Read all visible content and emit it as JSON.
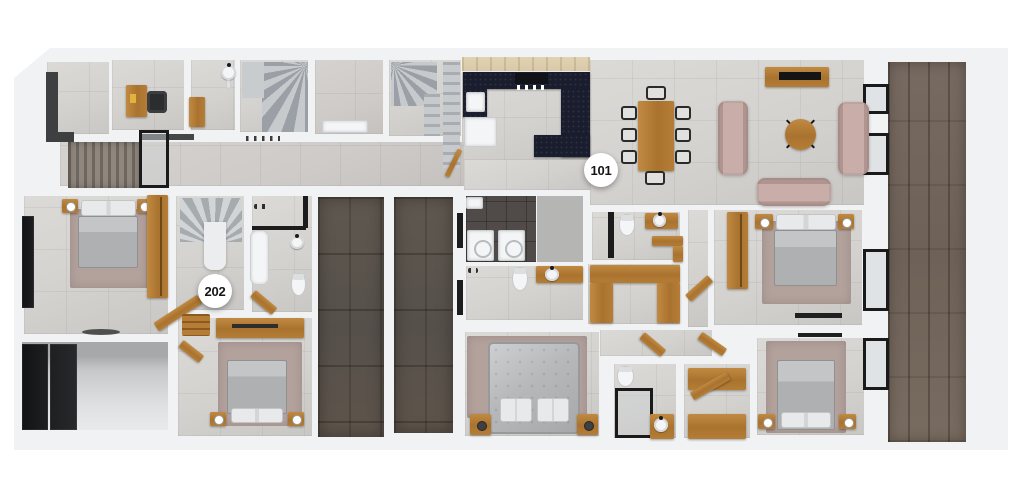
{
  "units": [
    {
      "id": "101",
      "label": "101"
    },
    {
      "id": "202",
      "label": "202"
    }
  ],
  "colors": {
    "wall": "#f1f2f4",
    "floor-light": "#d4d2cf",
    "floor-corridor": "#cecbc8",
    "floor-dark-tile": "#56504b",
    "deck-wood": "#6e6258",
    "laundry-tile": "#504b48",
    "wood": "#a9732f",
    "wood-light": "#c08a42",
    "cabinet-tan": "#d9c9a9",
    "counter-navy": "#1a1d2d",
    "sofa-mauve": "#c9ada9",
    "rug-mauve": "#b3a19c",
    "bed-gray": "#aeb0b2",
    "pillow-white": "#e8e9eb",
    "fixture-white": "#f4f5f6",
    "frame-black": "#1a1a1a",
    "stair-gray": "#c8cbce",
    "marker-bg": "#ffffff",
    "marker-text": "#161616"
  }
}
